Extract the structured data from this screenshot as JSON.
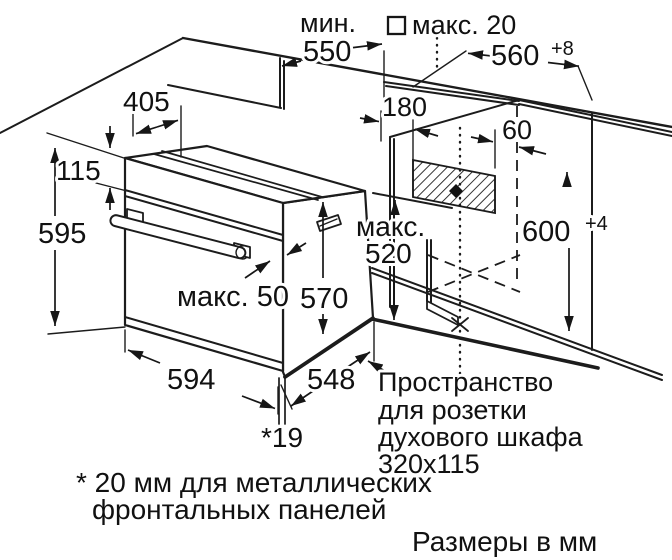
{
  "diagram": {
    "units_note": "Размеры в мм",
    "footnote": {
      "line1": "* 20 мм для металлических",
      "line2": "фронтальных панелей"
    },
    "socket_note": {
      "line1": "Пространство",
      "line2": "для розетки",
      "line3": "духового шкафа",
      "line4": "320x115"
    },
    "dimensions": {
      "min_label": "мин.",
      "min_depth": "550",
      "max_gap": "макс. 20",
      "niche_width": "560",
      "niche_width_tol": "+8",
      "top_depth": "405",
      "panel_height": "115",
      "oven_height": "595",
      "socket_offset": "180",
      "socket_side": "60",
      "niche_height": "600",
      "niche_height_tol": "+4",
      "max_label": "макс.",
      "max_inner": "520",
      "door_proj": "макс. 50",
      "body_height": "570",
      "oven_width": "594",
      "body_depth": "548",
      "rear_gap": "*19"
    },
    "colors": {
      "line": "#1c1c1c",
      "background": "#ffffff"
    }
  }
}
